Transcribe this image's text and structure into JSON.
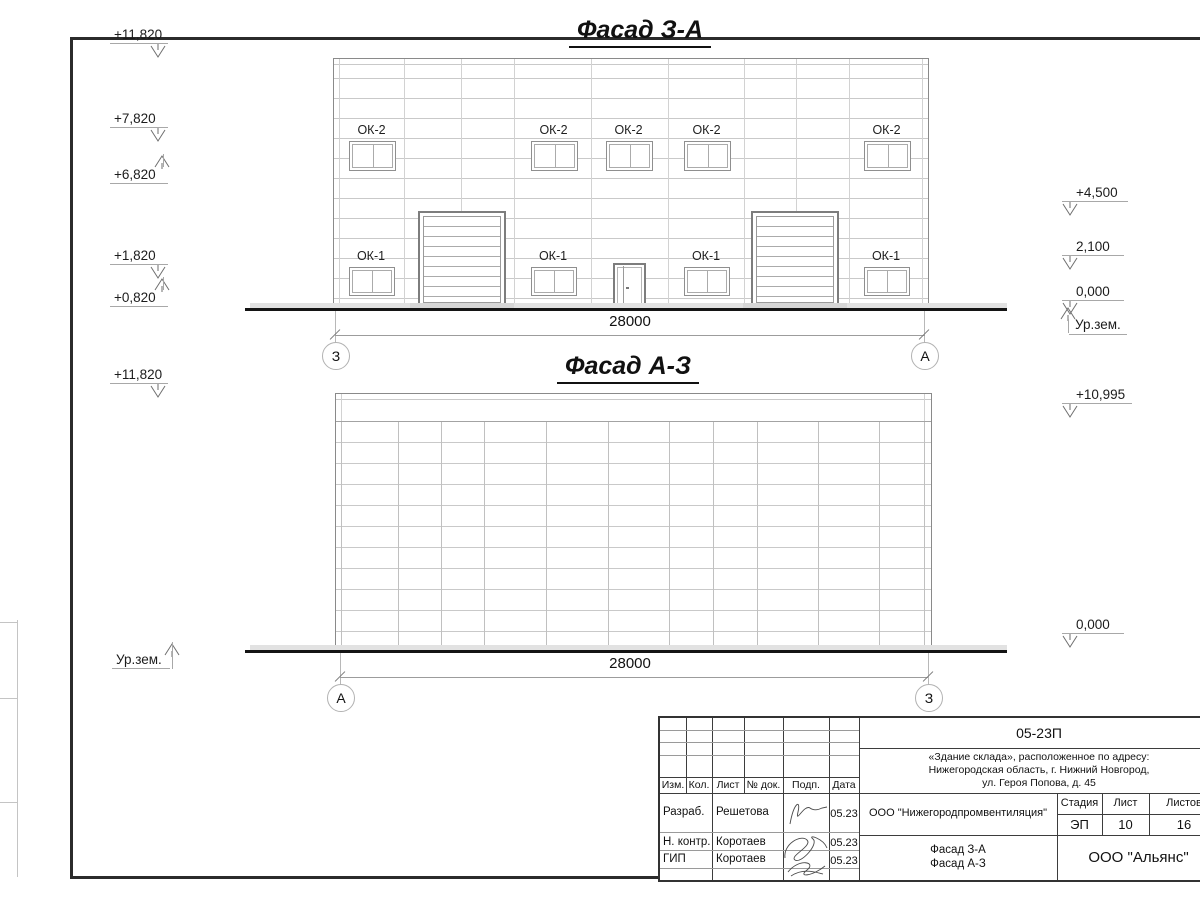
{
  "drawing": {
    "facade1": {
      "title": "Фасад З-А",
      "dimension": "28000",
      "axis_left": "З",
      "axis_right": "А",
      "levels_left": [
        "+11,820",
        "+7,820",
        "+6,820",
        "+1,820",
        "+0,820"
      ],
      "levels_right": [
        "+4,500",
        "2,100",
        "0,000"
      ],
      "ground_label": "Ур.зем.",
      "window_upper_label": "ОК-2",
      "window_lower_label": "ОК-1"
    },
    "facade2": {
      "title": "Фасад А-З",
      "dimension": "28000",
      "axis_left": "А",
      "axis_right": "З",
      "level_left_top": "+11,820",
      "ground_label": "Ур.зем.",
      "level_right_top": "+10,995",
      "level_right_bottom": "0,000"
    }
  },
  "titleblock": {
    "doc_number": "05-23П",
    "address_line1": "«Здание склада», расположенное по адресу:",
    "address_line2": "Нижегородская область, г. Нижний Новгород,",
    "address_line3": "ул. Героя Попова, д. 45",
    "columns": [
      "Изм.",
      "Кол.",
      "Лист",
      "№ док.",
      "Подп.",
      "Дата"
    ],
    "rows": [
      {
        "role": "Разраб.",
        "name": "Решетова",
        "date": "05.23"
      },
      {
        "role": "Н. контр.",
        "name": "Коротаев",
        "date": "05.23"
      },
      {
        "role": "ГИП",
        "name": "Коротаев",
        "date": "05.23"
      }
    ],
    "organization": "ООО \"Нижегородпромвентиляция\"",
    "stage_label": "Стадия",
    "sheet_label": "Лист",
    "sheets_label": "Листов",
    "stage_value": "ЭП",
    "sheet_value": "10",
    "sheets_value": "16",
    "drawing_title_line1": "Фасад З-А",
    "drawing_title_line2": "Фасад А-З",
    "company": "ООО \"Альянс\""
  }
}
